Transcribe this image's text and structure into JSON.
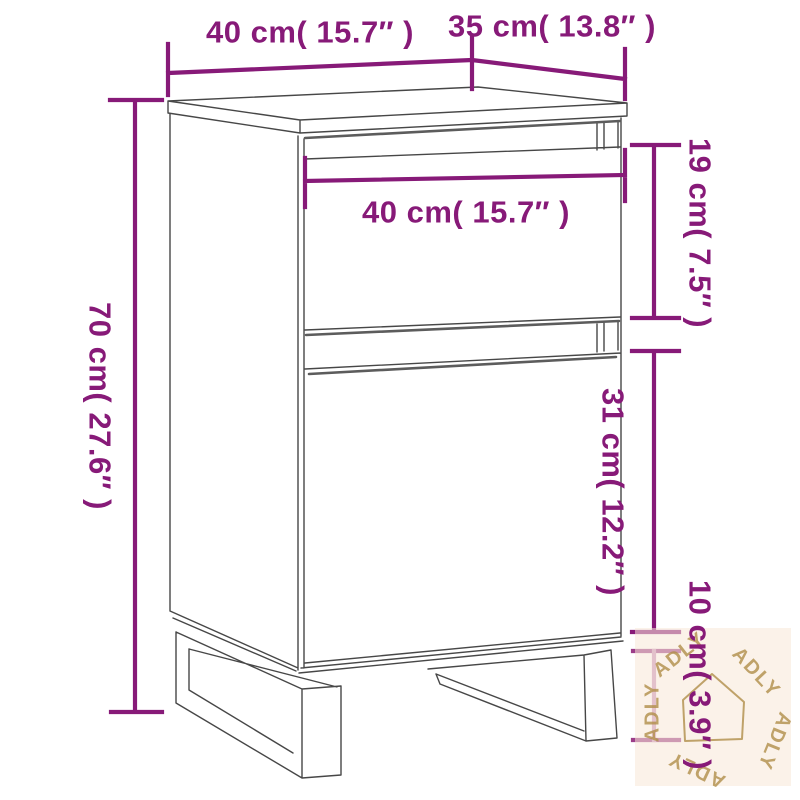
{
  "dimensions": {
    "top_width": "40 cm( 15.7″ )",
    "top_depth": "35 cm( 13.8″ )",
    "drawer_width": "40 cm( 15.7″ )",
    "drawer_height": "19 cm( 7.5″ )",
    "overall_height": "70 cm( 27.6″ )",
    "door_height": "31 cm( 12.2″ )",
    "leg_height": "10 cm( 3.9″ )"
  },
  "watermark": {
    "brand": "ADLY",
    "icon": "house-outline-icon"
  },
  "colors": {
    "dimension_primary": "#871a78",
    "dimension_faded_line": "#cb92bd",
    "dimension_faded_cap": "#9c3d88",
    "drawing_line": "#474747",
    "drawing_shadow": "#5c5c5c",
    "watermark_background": "#f7e7d7",
    "watermark_accent": "#b08d49",
    "background": "#ffffff"
  }
}
